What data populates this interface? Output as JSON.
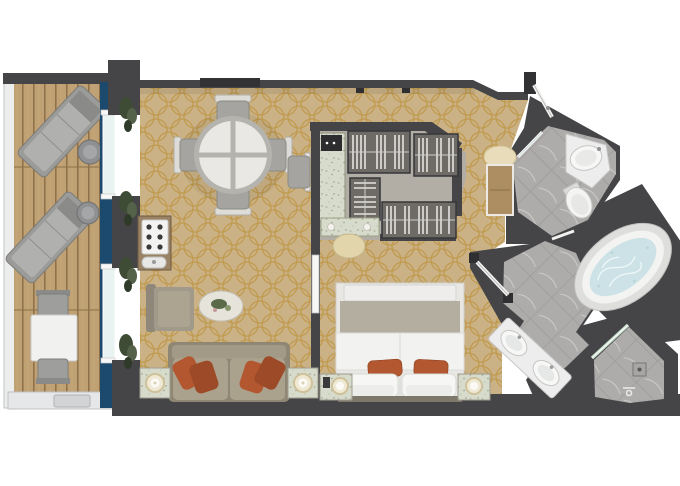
{
  "title": "cruise-suite-floor-plan",
  "colors": {
    "background": "#ffffff",
    "wall": "#454547",
    "wall_dark": "#323234",
    "carpet_base": "#cbb286",
    "carpet_pattern": "#bd9440",
    "deck_wood": "#bfa173",
    "deck_plank": "#8d7048",
    "rail": "#e9eaec",
    "rail_stroke": "#b5b7b9",
    "window_band": "#1c4a6e",
    "glass": "#e9f3f2",
    "plant_green": "#3f4c35",
    "plant_light": "#55624a",
    "tile": "#aeacaa",
    "tile_grout": "#999795",
    "tile_vein": "#d8d6d3",
    "fixture_white": "#f4f4f2",
    "fixture_stroke": "#c6c6c4",
    "tub_water": "#cde2e6",
    "sofa_frame": "#8f8774",
    "sofa_body": "#a29a87",
    "sofa_cushion": "#aba28e",
    "accent_pillow": "#b2572f",
    "accent_pillow_dark": "#9c4a28",
    "chair_gray": "#a5a4a0",
    "chair_back": "#e3e2de",
    "table_top": "#e9e8e4",
    "table_rim": "#b5b3ad",
    "bar_wood": "#9a8264",
    "marble_speck": "#d7dbcc",
    "stool_cream": "#e2d5ac",
    "wardrobe": "#6e6a66",
    "wardrobe_stripe": "#e3e3e1",
    "closet_floor": "#b2aea6",
    "safe_dark": "#2d2d2f",
    "bed_white": "#f2f2f0",
    "bed_blanket": "#b4aea1",
    "nightstand": "#cfc9ba",
    "lamp": "#efe9d4",
    "lamp_ring": "#cfc19a",
    "console_wood": "#ad8e62",
    "cream_arc": "#e8dcba",
    "shower_glass": "#cfe6d2",
    "drain": "#a8a6a4"
  },
  "rooms": [
    {
      "name": "balcony",
      "floor": "teak-deck"
    },
    {
      "name": "living-dining-room",
      "floor": "patterned-carpet"
    },
    {
      "name": "walk-in-closet",
      "floor": "carpet"
    },
    {
      "name": "bedroom",
      "floor": "patterned-carpet"
    },
    {
      "name": "entry-hall",
      "floor": "patterned-carpet"
    },
    {
      "name": "guest-bathroom",
      "floor": "marble-tile"
    },
    {
      "name": "master-bathroom",
      "floor": "marble-tile"
    },
    {
      "name": "shower-room",
      "floor": "marble-tile"
    }
  ],
  "furniture": {
    "balcony": [
      "sun-lounger",
      "sun-lounger",
      "round-side-table",
      "round-side-table",
      "outdoor-table",
      "outdoor-chair",
      "outdoor-chair"
    ],
    "living_room": [
      "round-dining-table",
      "dining-chair-x4",
      "desk-chair",
      "minibar-cabinet",
      "armchair",
      "oval-coffee-table",
      "sofa-with-accent-pillows",
      "lamp-side-table-x2",
      "floor-plant-x4"
    ],
    "closet": [
      "wardrobe-unit-x4",
      "cabinet-with-safe"
    ],
    "bedroom": [
      "double-bed",
      "nightstand-x2",
      "table-lamp-x2",
      "vanity-desk",
      "vanity-stool",
      "telephone"
    ],
    "entry": [
      "entrance-door",
      "console-table"
    ],
    "bathrooms": [
      "corner-sink",
      "toilet",
      "double-sink-vanity",
      "jacuzzi-tub",
      "walk-in-shower",
      "shower-drain",
      "glass-door-x2"
    ]
  }
}
